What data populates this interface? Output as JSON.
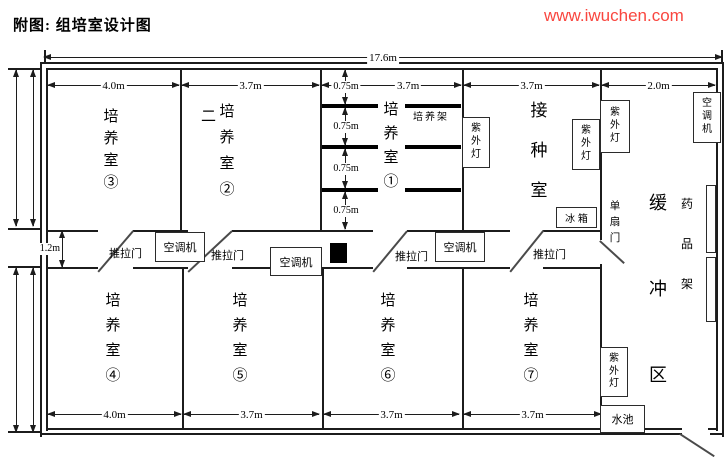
{
  "title": "附图: 组培室设计图",
  "watermark": {
    "text": "www.iwuchen.com",
    "color": "#f9463f"
  },
  "colors": {
    "wall": "#1c1c1c",
    "door_line": "#4a4a4a",
    "rack": "#000000"
  },
  "dims": {
    "overall": "17.6m",
    "corridor": "1.2m",
    "top": [
      "4.0m",
      "3.7m",
      "3.7m",
      "3.7m",
      "2.0m"
    ],
    "bottom": [
      "4.0m",
      "3.7m",
      "3.7m",
      "3.7m"
    ],
    "racks": [
      "0.75m",
      "0.75m",
      "0.75m",
      "0.75m"
    ]
  },
  "rooms": {
    "room3": "培养室③",
    "room2_prefix": "二",
    "room2": "培养室②",
    "room1": "培养室①",
    "inoculation": "接种室",
    "buffer": "缓冲区",
    "room4": "培养室④",
    "room5": "培养室⑤",
    "room6": "培养室⑥",
    "room7": "培养室⑦"
  },
  "equipment": {
    "ac": "空调机",
    "uv": "紫外灯",
    "fridge": "冰 箱",
    "sink": "水池",
    "culture_rack": "培养架",
    "medicine_rack": "药品架"
  },
  "doors": {
    "sliding": "推拉门",
    "single": "单扇门"
  }
}
